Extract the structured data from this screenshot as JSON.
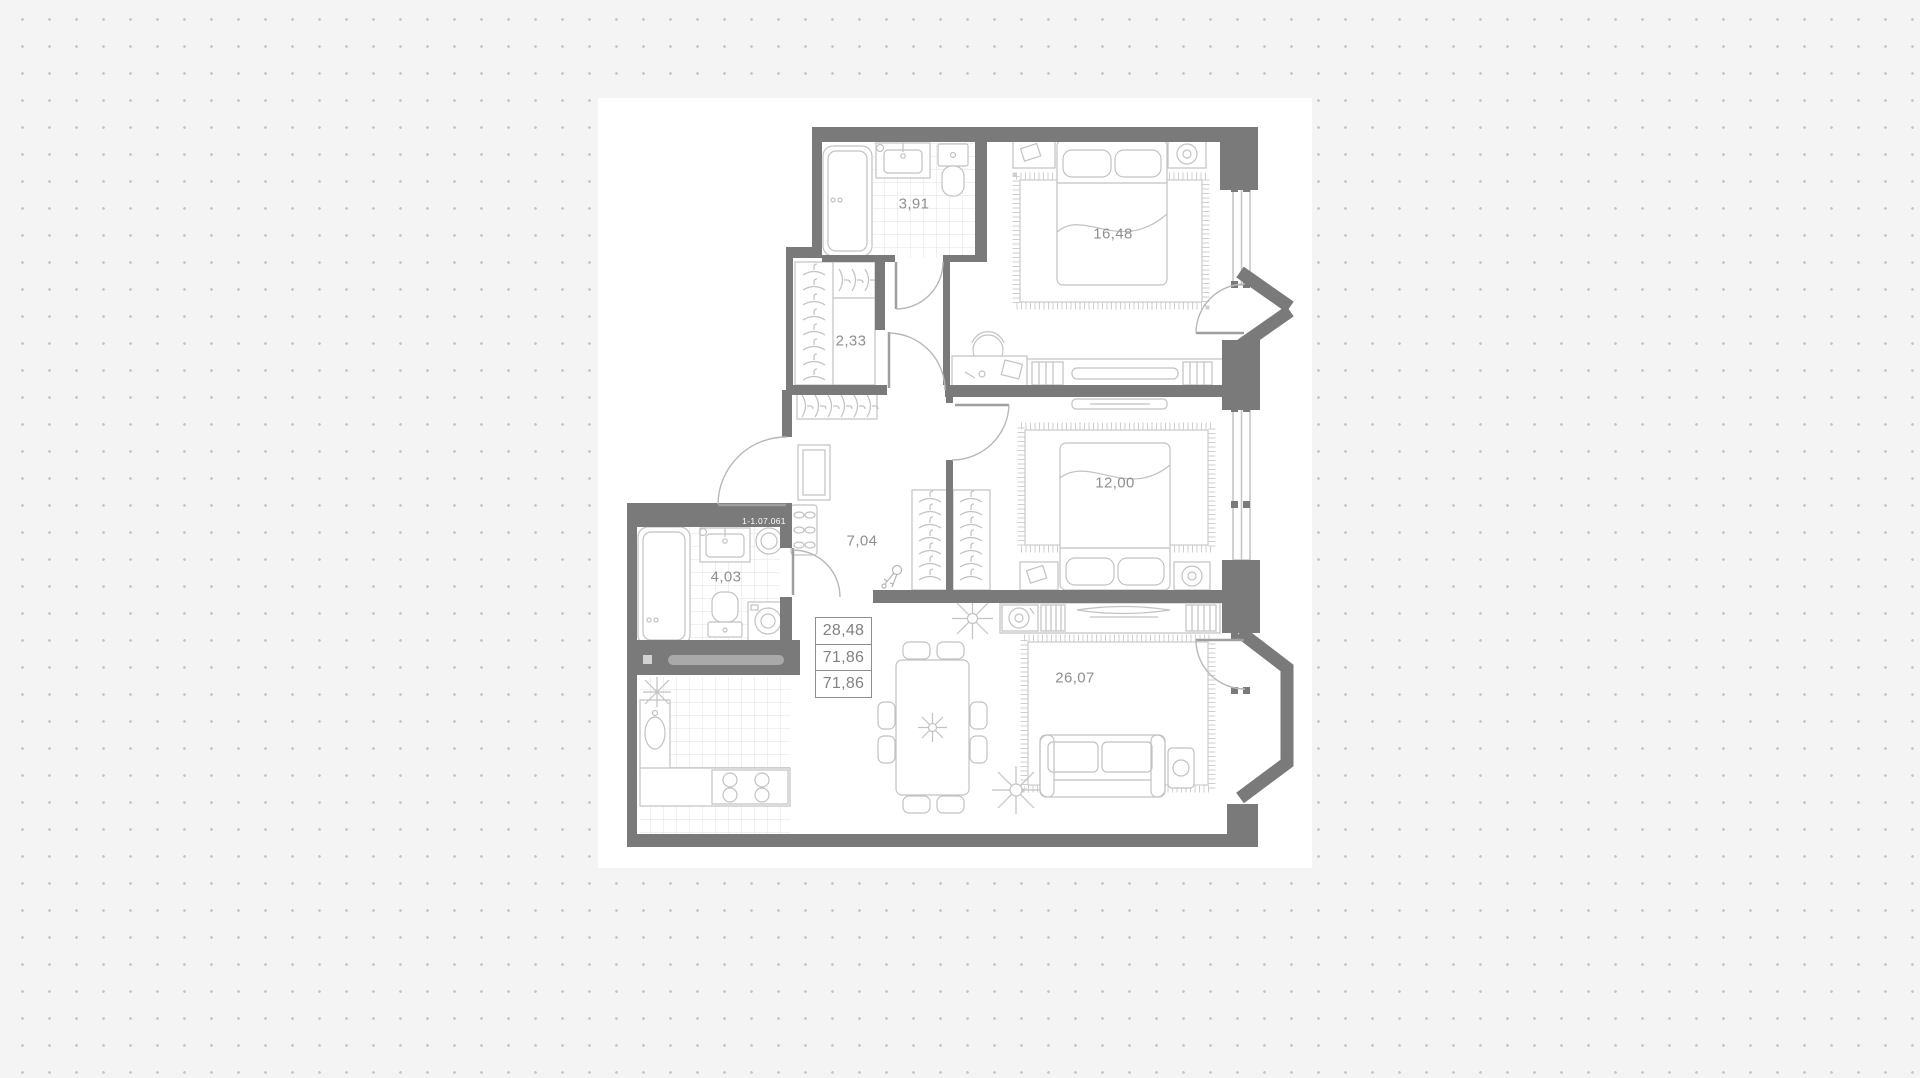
{
  "plan": {
    "apartment_number": "1-1.07.061",
    "rooms": {
      "bathroom": {
        "area": "3,91"
      },
      "wardrobe": {
        "area": "2,33"
      },
      "bedroom_main": {
        "area": "16,48"
      },
      "bedroom_second": {
        "area": "12,00"
      },
      "corridor": {
        "area": "7,04"
      },
      "bathroom_second": {
        "area": "4,03"
      },
      "living_kitchen": {
        "area": "26,07"
      }
    },
    "area_table": [
      "28,48",
      "71,86",
      "71,86"
    ],
    "colors": {
      "background": "#f4f4f4",
      "dots": "#c7c7c7",
      "walls": "#7a7a7a",
      "furniture_outline": "#c2c2c2",
      "label_text": "#8f8f8f",
      "plan_floor": "#ffffff"
    }
  }
}
